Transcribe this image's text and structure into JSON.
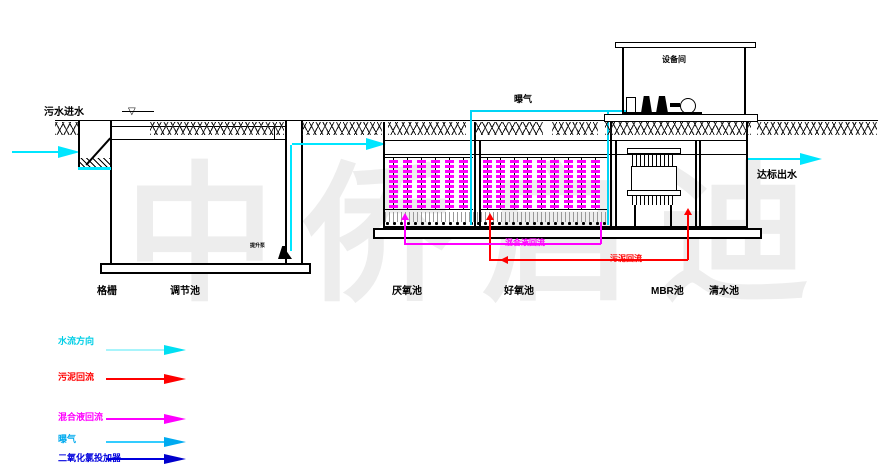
{
  "colors": {
    "line": "#000000",
    "water": "#00e6ff",
    "sludge": "#ff0000",
    "mixed_liquor": "#ff00ff",
    "aeration_pipe": "#00d4f5",
    "dosing": "#0000dd",
    "watermark": "#ededed"
  },
  "labels": {
    "inlet": "污水进水",
    "outlet": "达标出水",
    "aeration": "曝气",
    "equipment_room": "设备间",
    "pump": "提升泵",
    "mixed_liquor_return": "混合液回流",
    "sludge_return": "污泥回流"
  },
  "tanks": [
    {
      "name": "格栅"
    },
    {
      "name": "调节池"
    },
    {
      "name": "厌氧池"
    },
    {
      "name": "好氧池"
    },
    {
      "name": "MBR池"
    },
    {
      "name": "清水池"
    }
  ],
  "legend": {
    "items": [
      {
        "label": "水流方向",
        "color": "#00cfe6",
        "line_color": "#a8f4fb",
        "head_color": "#00dff2"
      },
      {
        "label": "污泥回流",
        "color": "#ff0000",
        "line_color": "#ff0000",
        "head_color": "#ff0000"
      },
      {
        "label": "混合液回流",
        "color": "#ff00ff",
        "line_color": "#ff00ff",
        "head_color": "#ff00ff"
      },
      {
        "label": "曝气",
        "color": "#00aaee",
        "line_color": "#33ccff",
        "head_color": "#00aaf0"
      },
      {
        "label": "二氧化氯投加器",
        "color": "#0000dd",
        "line_color": "#0000dd",
        "head_color": "#0000cc"
      }
    ]
  },
  "watermark": "中侨启迪"
}
